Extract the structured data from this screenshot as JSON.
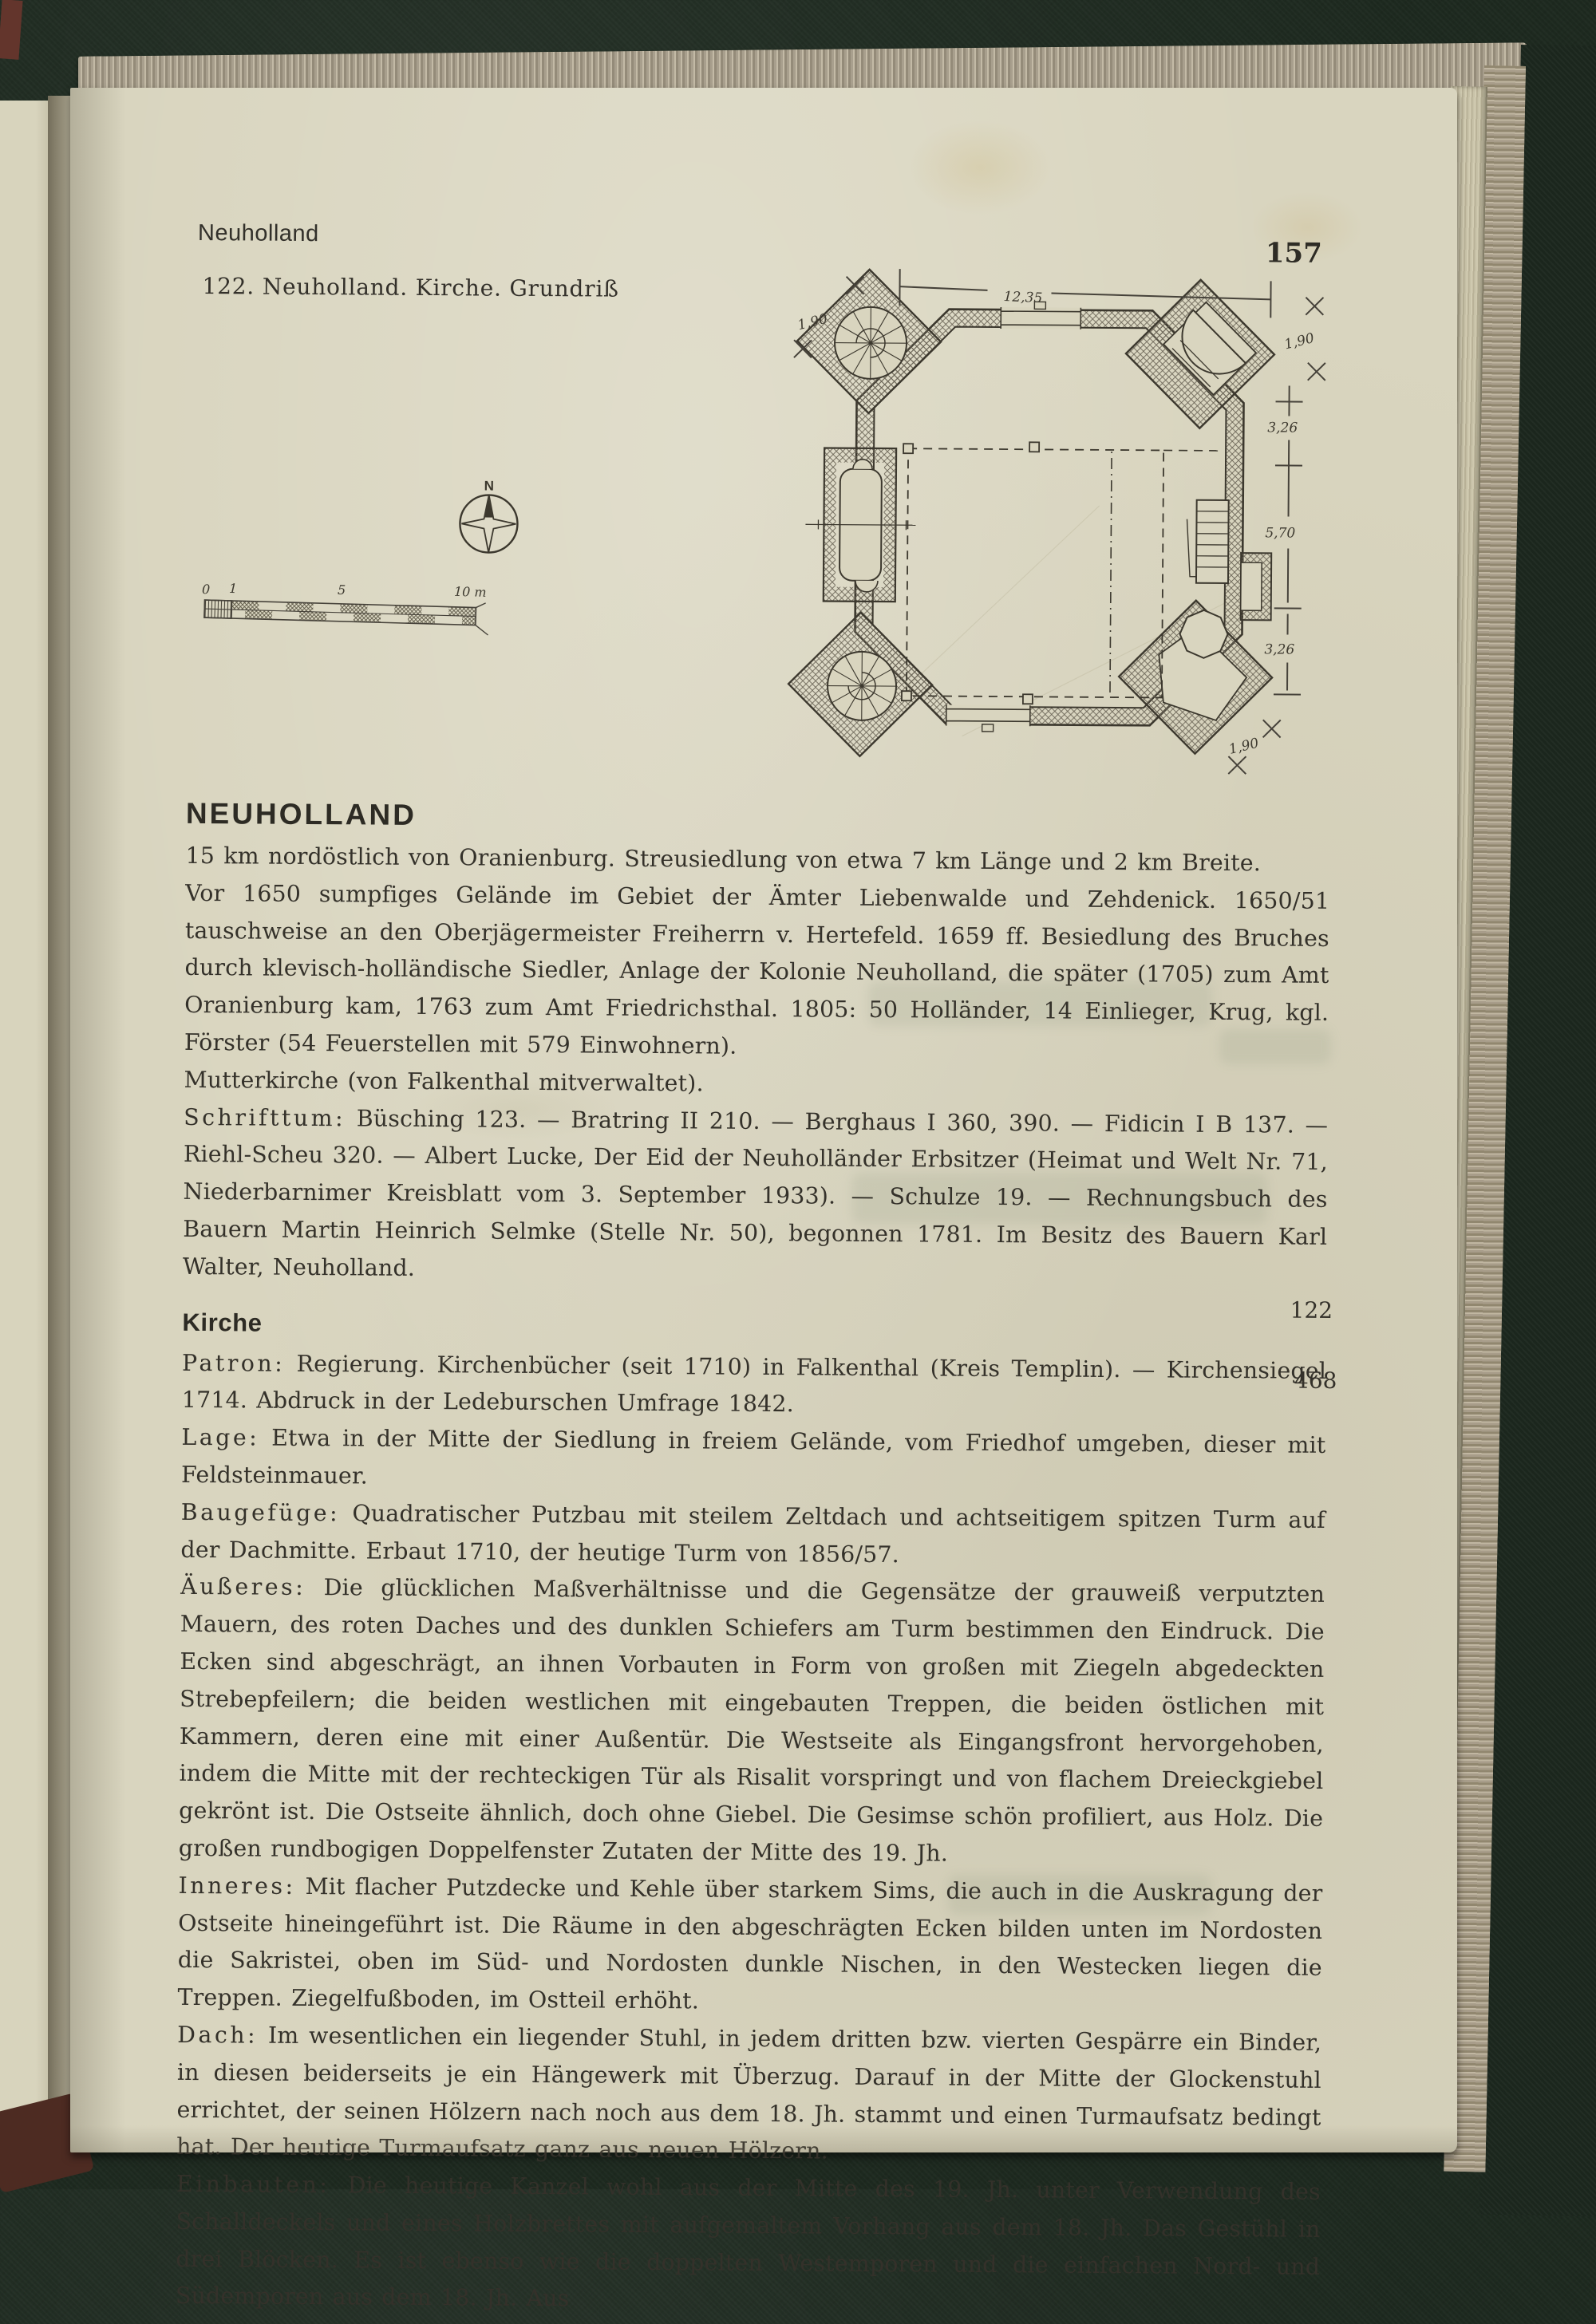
{
  "header": {
    "running_head": "Neuholland",
    "page_number": "157"
  },
  "figure": {
    "caption": "122. Neuholland. Kirche. Grundriß",
    "compass_label": "N",
    "scale_labels": {
      "zero": "0",
      "one": "1",
      "five": "5",
      "ten": "10 m"
    },
    "dimensions": {
      "top_width": "12,35",
      "corner_nw": "1,90",
      "corner_ne": "1,90",
      "right_upper": "3,26",
      "right_middle": "5,70",
      "right_lower": "3,26",
      "corner_se": "1,90"
    }
  },
  "article": {
    "title": "NEUHOLLAND",
    "intro": [
      {
        "text": "15 km nordöstlich von Oranienburg. Streusiedlung von etwa 7 km Länge und 2 km Breite."
      },
      {
        "text": "Vor 1650 sumpfiges Gelände im Gebiet der Ämter Liebenwalde und Zehdenick. 1650/51 tauschweise an den Oberjägermeister Freiherrn v. Hertefeld. 1659 ff. Besiedlung des Bruches durch klevisch-holländische Siedler, Anlage der Kolonie Neuholland, die später (1705) zum Amt Oranienburg kam, 1763 zum Amt Friedrichsthal. 1805: 50 Holländer, 14 Einlieger, Krug, kgl. Förster (54 Feuerstellen mit 579 Einwohnern)."
      },
      {
        "text": "Mutterkirche (von Falkenthal mitverwaltet)."
      },
      {
        "lead": "Schrifttum:",
        "text": " Büsching 123. — Bratring II 210. — Berghaus I 360, 390. — Fidicin I B 137. — Riehl-Scheu 320. — Albert Lucke, Der Eid der Neuholländer Erbsitzer (Heimat und Welt Nr. 71, Niederbarnimer Kreisblatt vom 3. September 1933). — Schulze 19. — Rechnungsbuch des Bauern Martin Heinrich Selmke (Stelle Nr. 50), begonnen 1781. Im Besitz des Bauern Karl Walter, Neuholland."
      }
    ],
    "section_title": "Kirche",
    "entries": [
      {
        "lead": "Patron:",
        "text": " Regierung. Kirchenbücher (seit 1710) in Falkenthal (Kreis Templin). — Kirchensiegel 1714. Abdruck in der Ledeburschen Umfrage 1842."
      },
      {
        "lead": "Lage:",
        "text": " Etwa in der Mitte der Siedlung in freiem Gelände, vom Friedhof umgeben, dieser mit Feldsteinmauer."
      },
      {
        "lead": "Baugefüge:",
        "text": " Quadratischer Putzbau mit steilem Zeltdach und achtseitigem spitzen Turm auf der Dachmitte. Erbaut 1710, der heutige Turm von 1856/57."
      },
      {
        "lead": "Äußeres:",
        "text": " Die glücklichen Maßverhältnisse und die Gegensätze der grauweiß verputzten Mauern, des roten Daches und des dunklen Schiefers am Turm bestimmen den Eindruck. Die Ecken sind abgeschrägt, an ihnen Vorbauten in Form von großen mit Ziegeln abgedeckten Strebepfeilern; die beiden westlichen mit eingebauten Treppen, die beiden östlichen mit Kammern, deren eine mit einer Außentür. Die Westseite als Eingangsfront hervorgehoben, indem die Mitte mit der rechteckigen Tür als Risalit vorspringt und von flachem Dreieckgiebel gekrönt ist. Die Ostseite ähnlich, doch ohne Giebel. Die Gesimse schön profiliert, aus Holz. Die großen rundbogigen Doppelfenster Zutaten der Mitte des 19. Jh."
      },
      {
        "lead": "Inneres:",
        "text": " Mit flacher Putzdecke und Kehle über starkem Sims, die auch in die Auskragung der Ostseite hineingeführt ist. Die Räume in den abgeschrägten Ecken bilden unten im Nordosten die Sakristei, oben im Süd- und Nordosten dunkle Nischen, in den Westecken liegen die Treppen. Ziegelfußboden, im Ostteil erhöht."
      },
      {
        "lead": "Dach:",
        "text": " Im wesentlichen ein liegender Stuhl, in jedem dritten bzw. vierten Gespärre ein Binder, in diesen beiderseits je ein Hängewerk mit Überzug. Darauf in der Mitte der Glockenstuhl errichtet, der seinen Hölzern nach noch aus dem 18. Jh. stammt und einen Turmaufsatz bedingt hat. Der heutige Turmaufsatz ganz aus neuen Hölzern."
      },
      {
        "lead": "Einbauten:",
        "text": " Die heutige Kanzel wohl aus der Mitte des 19. Jh. unter Verwendung des Schalldeckels und eines Holzbrettes mit aufgemaltem Vorhang aus dem 18. Jh. Das Gestühl in drei Blöcken. Es ist ebenso wie die doppelten Westemporen und die einfachen Nord- und Südemporen aus dem 18. Jh. Aus"
      }
    ],
    "margin_refs": [
      {
        "value": "122"
      },
      {
        "value": "468"
      }
    ]
  }
}
